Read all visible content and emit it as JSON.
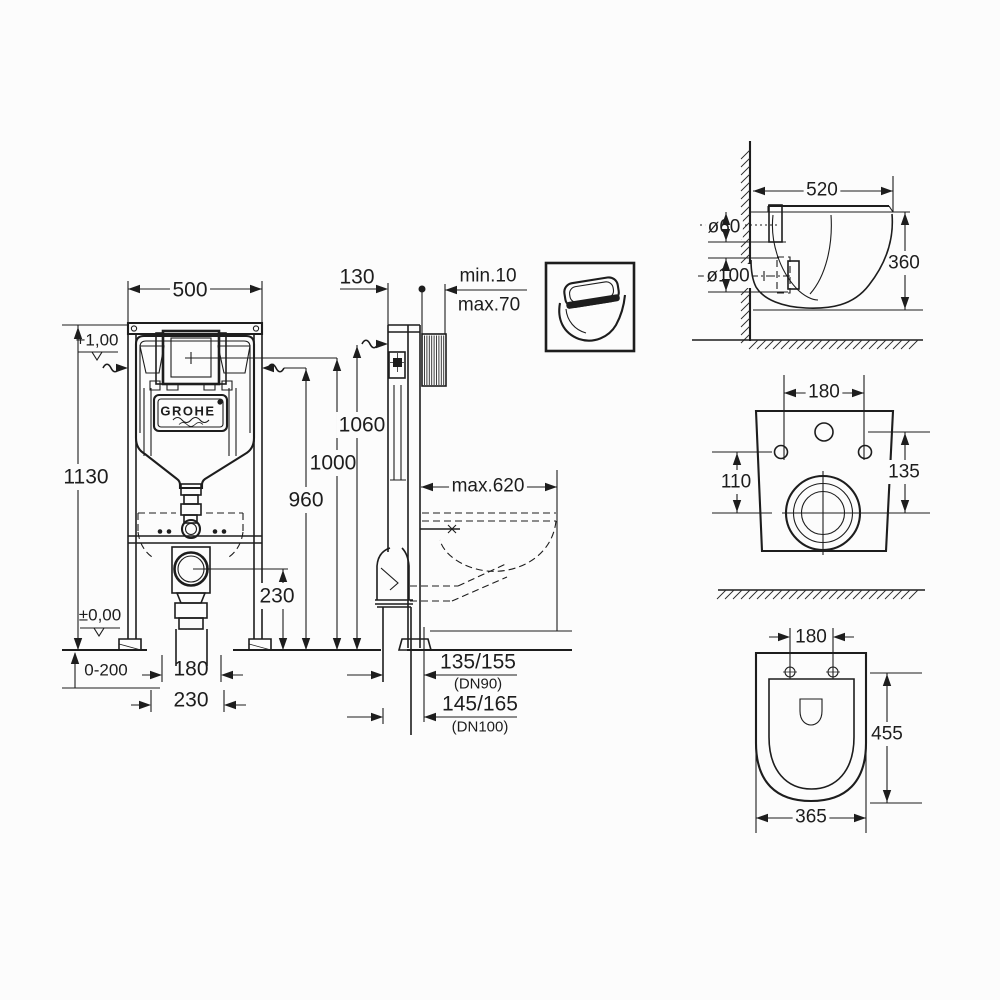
{
  "labels": {
    "brand": "GROHE",
    "front": {
      "width": "500",
      "height": "1130",
      "plus_level": "+1,00",
      "zero_level": "±0,00",
      "floor_adjust": "0-200",
      "pipe_width": "180",
      "pipe_offset": "230",
      "drain_height": "230",
      "h960": "960",
      "h1000": "1000",
      "h1060": "1060"
    },
    "side": {
      "depth": "130",
      "wall_min": "min.10",
      "wall_max": "max.70",
      "pan_reach": "max.620",
      "dn90_value": "135/155",
      "dn90_name": "(DN90)",
      "dn100_value": "145/165",
      "dn100_name": "(DN100)"
    },
    "pan_side": {
      "depth": "520",
      "flush_dia": "ø60",
      "outlet_dia": "ø100",
      "height": "360"
    },
    "pan_back": {
      "bolt_spacing": "180",
      "outlet_to_bolts": "110",
      "outlet_to_top": "135"
    },
    "pan_top": {
      "bolt_spacing": "180",
      "length": "455",
      "width": "365"
    }
  }
}
